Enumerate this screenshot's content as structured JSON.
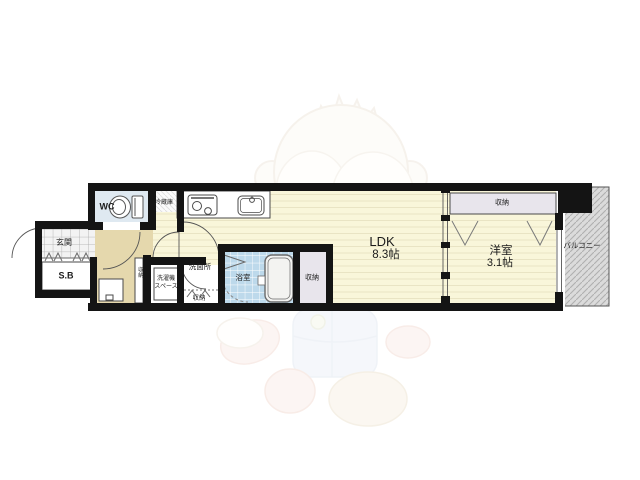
{
  "plan": {
    "type": "apartment-floor-plan",
    "rooms": {
      "ldk": {
        "name": "LDK",
        "size": "8.3帖"
      },
      "bedroom": {
        "name": "洋室",
        "size": "3.1帖"
      },
      "wc": {
        "label": "WC"
      },
      "entrance": {
        "label": "玄関"
      },
      "shoebox": {
        "label": "S.B"
      },
      "fridge": {
        "label": "冷蔵庫"
      },
      "washroom": {
        "label": "洗面所"
      },
      "laundry": {
        "label_line1": "洗濯機",
        "label_line2": "スペース"
      },
      "bath": {
        "label": "浴室"
      },
      "closet_hall": {
        "label": "収納"
      },
      "closet_washroom": {
        "label": "収納"
      },
      "closet_bathside": {
        "label": "収納"
      },
      "closet_bedroom": {
        "label": "収納"
      },
      "balcony": {
        "label": "バルコニー"
      }
    },
    "colors": {
      "wall": "#141414",
      "wood_floor": "#f9f6da",
      "wood_stripe": "#e8e2c2",
      "hall_tan": "#e5d8ad",
      "wc_floor": "#dfe9f1",
      "bath_tile": "#bdd9eb",
      "closet_fill": "#e8e5ec",
      "balcony_fill": "#dbdbdb"
    }
  }
}
